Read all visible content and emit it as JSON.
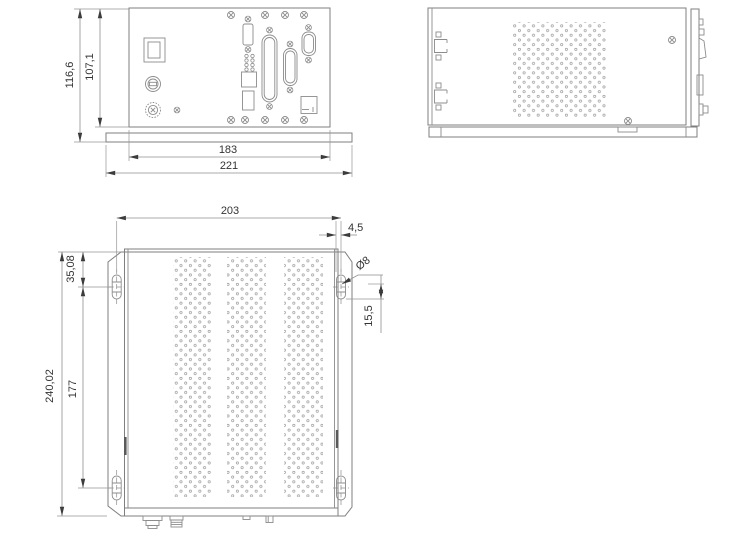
{
  "drawing": {
    "units_note": "",
    "colors": {
      "outline": "#7f7f7f",
      "component": "#8c8c8c",
      "dimension_line": "#8f8f8f",
      "arrow": "#3c3c3c",
      "text": "#333333",
      "perforation": "#9c9c9c"
    },
    "dims": {
      "front": {
        "overall_height": "116,6",
        "panel_height": "107,1",
        "panel_width": "183",
        "overall_width": "221"
      },
      "bottom": {
        "hole_spacing_h": "203",
        "hole_edge_offset": "4,5",
        "hole_diameter": "Ø8",
        "hole_corner_offset": "15,5",
        "hole_top_offset": "35,08",
        "hole_spacing_v": "177",
        "overall_height": "240,02"
      }
    }
  }
}
